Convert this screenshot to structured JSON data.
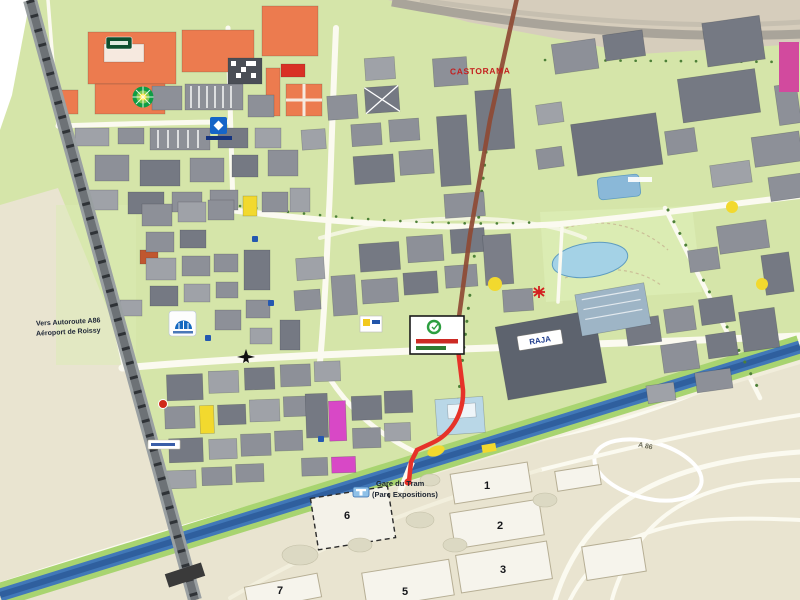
{
  "map": {
    "labels": {
      "castorama": "CASTORAMA",
      "raja": "RAJA",
      "station_line1": "Gare du Tram",
      "station_line2": "(Parc Expositions)",
      "left_caption_line1": "Vers Autoroute A86",
      "left_caption_line2": "Aéroport de Roissy",
      "road_a86": "A 86"
    },
    "halls": [
      {
        "num": "1"
      },
      {
        "num": "2"
      },
      {
        "num": "3"
      },
      {
        "num": "5"
      },
      {
        "num": "6"
      },
      {
        "num": "7"
      }
    ],
    "icons": {
      "bp": "bp-logo",
      "blue_square": "blue-logo",
      "dome": "dome-logo",
      "plane": "plane-icon",
      "asterisk": "red-asterisk-icon",
      "tram": "tram-station-icon",
      "parking": "parking-icon",
      "callout": "highlight-callout",
      "red_dot": "red-dot-logo"
    },
    "colors": {
      "grass": "#d5e5a9",
      "beige": "#e9e4d0",
      "band": "#d6cdbc",
      "canal": "#4178b8",
      "canaldark": "#2f5f9e",
      "bank": "#a8d470",
      "route": "#e63229",
      "routedark": "#8e4a34",
      "orange": "#ec7b4f",
      "yellow": "#f2d92e",
      "magenta": "#d848c6",
      "hall": "#f6f4ec",
      "pond": "#a4d2e6"
    }
  }
}
